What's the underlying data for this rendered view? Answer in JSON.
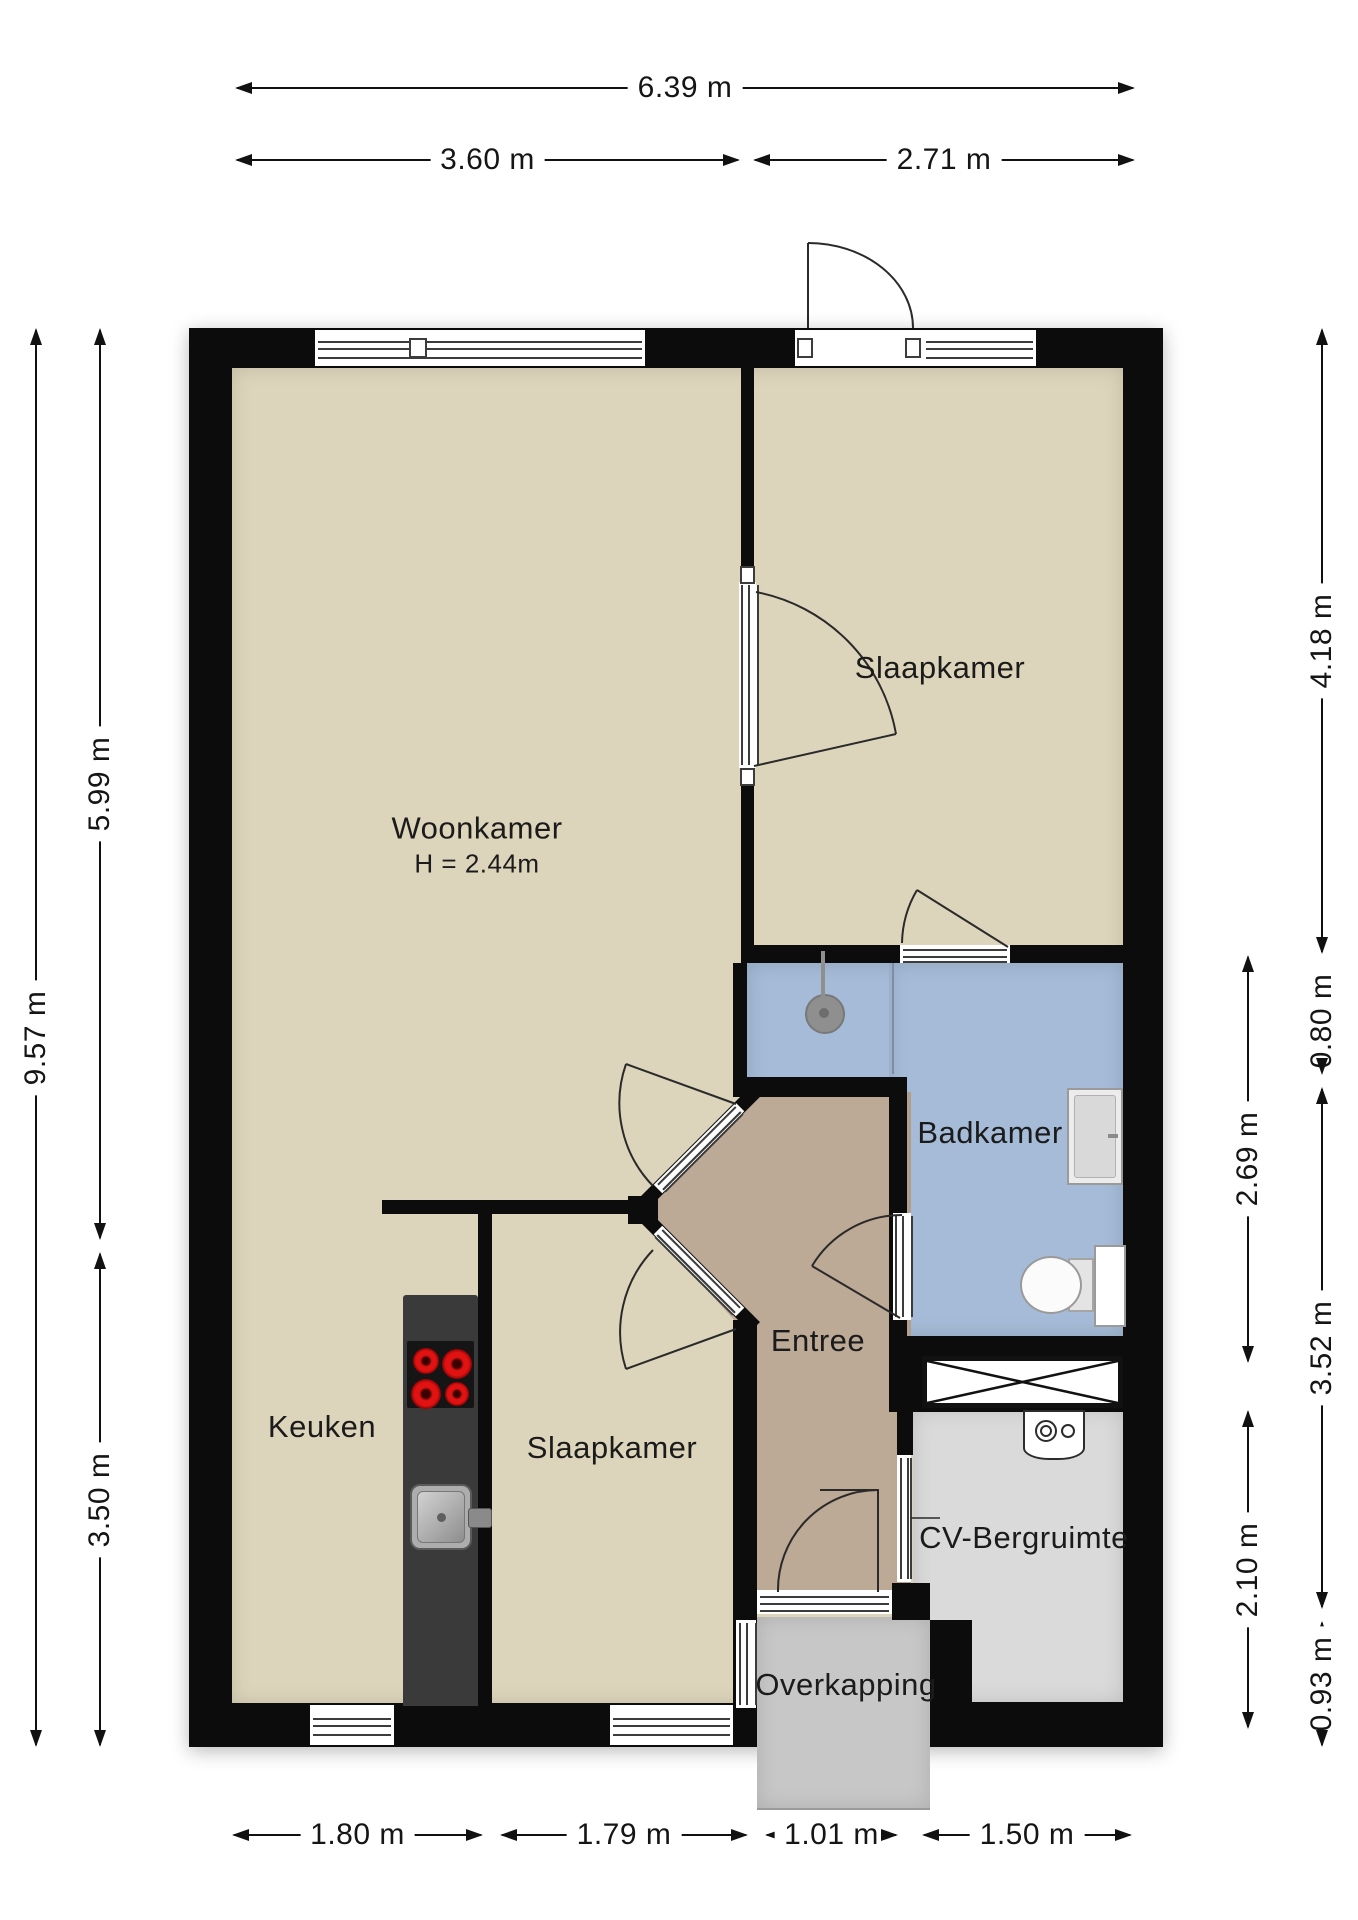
{
  "plan": {
    "type": "floorplan",
    "language": "nl"
  },
  "colors": {
    "wall": "#0c0c0c",
    "floor-beige": "#ddd5bb",
    "floor-entree": "#bca996",
    "floor-bath": "#a5bbd7",
    "floor-cv": "#dadada",
    "floor-overkapping": "#c7c7c7",
    "counter-dark": "#3a3a3a",
    "burner-red": "#d01010"
  },
  "rooms": {
    "woonkamer": {
      "label": "Woonkamer",
      "height_note": "H = 2.44m"
    },
    "slaapkamer_top": {
      "label": "Slaapkamer"
    },
    "badkamer": {
      "label": "Badkamer"
    },
    "entree": {
      "label": "Entree"
    },
    "keuken": {
      "label": "Keuken"
    },
    "slaapkamer_bottom": {
      "label": "Slaapkamer"
    },
    "cv_bergruimte": {
      "label": "CV-Bergruimte"
    },
    "overkapping": {
      "label": "Overkapping"
    }
  },
  "dimensions": {
    "top_total": "6.39 m",
    "top_left": "3.60 m",
    "top_right": "2.71 m",
    "left_total": "9.57 m",
    "left_upper": "5.99 m",
    "left_lower": "3.50 m",
    "right_outer_upper": "4.18 m",
    "right_outer_small": "0.80 m",
    "right_inner_upper": "2.69 m",
    "right_outer_mid": "3.52 m",
    "right_inner_lower": "2.10 m",
    "right_outer_bottom": "0.93 m",
    "bottom_1": "1.80 m",
    "bottom_2": "1.79 m",
    "bottom_3": "1.01 m",
    "bottom_4": "1.50 m"
  }
}
